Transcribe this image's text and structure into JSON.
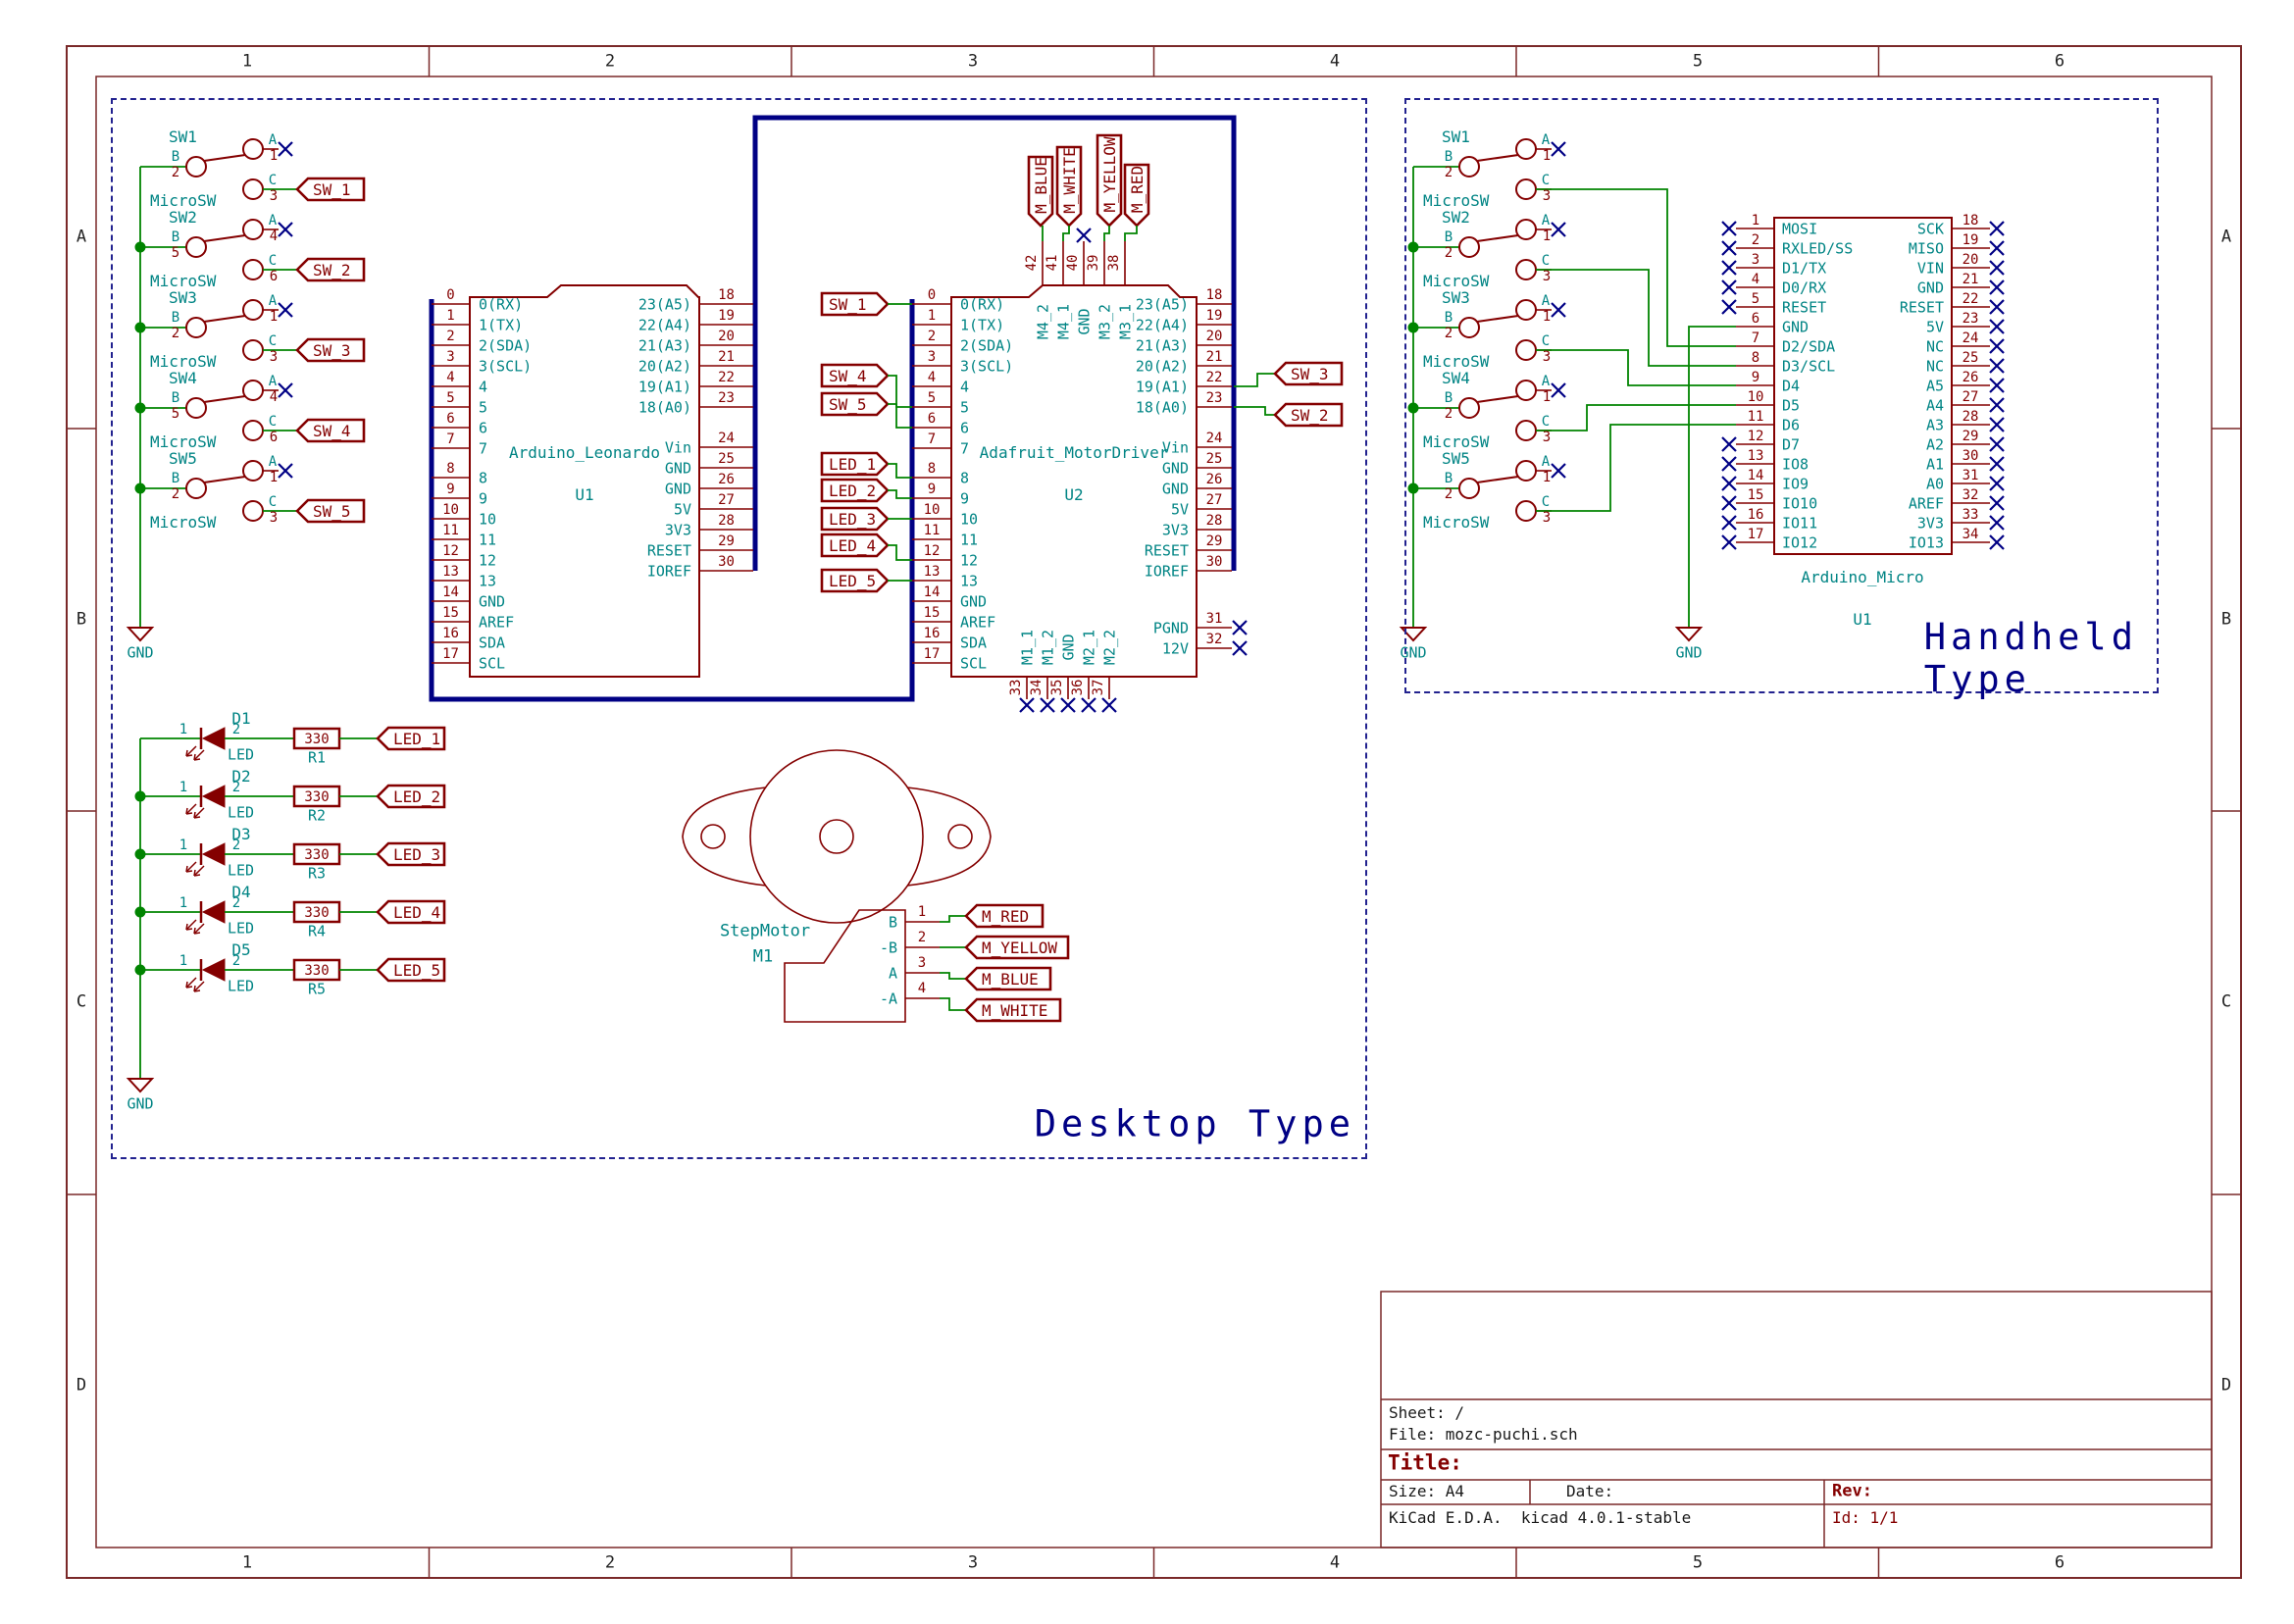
{
  "sheet": {
    "cols": [
      "1",
      "2",
      "3",
      "4",
      "5",
      "6"
    ],
    "rows": [
      "A",
      "B",
      "C",
      "D"
    ],
    "title_block": {
      "sheet": "Sheet: /",
      "file": "File: mozc-puchi.sch",
      "title": "Title:",
      "size": "Size: A4",
      "date": "Date:",
      "rev": "Rev:",
      "kicad": "KiCad E.D.A.  kicad 4.0.1-stable",
      "id": "Id: 1/1"
    }
  },
  "groups": {
    "desktop": "Desktop Type",
    "handheld": "Handheld Type"
  },
  "colors": {
    "component": "#840000",
    "field": "#008484",
    "wire": "#008400",
    "bus": "#000084",
    "noconnect": "#000084",
    "border": "#7a2929"
  },
  "misc": {
    "gnd": "GND"
  },
  "desktop": {
    "switches": [
      {
        "ref": "SW1",
        "value": "MicroSW",
        "pins": [
          {
            "l": "A",
            "n": "1"
          },
          {
            "l": "B",
            "n": "2"
          },
          {
            "l": "C",
            "n": "3"
          }
        ],
        "net": "SW_1"
      },
      {
        "ref": "SW2",
        "value": "MicroSW",
        "pins": [
          {
            "l": "A",
            "n": "4"
          },
          {
            "l": "B",
            "n": "5"
          },
          {
            "l": "C",
            "n": "6"
          }
        ],
        "net": "SW_2"
      },
      {
        "ref": "SW3",
        "value": "MicroSW",
        "pins": [
          {
            "l": "A",
            "n": "1"
          },
          {
            "l": "B",
            "n": "2"
          },
          {
            "l": "C",
            "n": "3"
          }
        ],
        "net": "SW_3"
      },
      {
        "ref": "SW4",
        "value": "MicroSW",
        "pins": [
          {
            "l": "A",
            "n": "4"
          },
          {
            "l": "B",
            "n": "5"
          },
          {
            "l": "C",
            "n": "6"
          }
        ],
        "net": "SW_4"
      },
      {
        "ref": "SW5",
        "value": "MicroSW",
        "pins": [
          {
            "l": "A",
            "n": "1"
          },
          {
            "l": "B",
            "n": "2"
          },
          {
            "l": "C",
            "n": "3"
          }
        ],
        "net": "SW_5"
      }
    ],
    "u2_left_nets": [
      "SW_1",
      "SW_4",
      "SW_5",
      "LED_1",
      "LED_2",
      "LED_3",
      "LED_4",
      "LED_5"
    ],
    "u2_right_nets": [
      "SW_3",
      "SW_2"
    ],
    "u2_top_nets": [
      "M_BLUE",
      "M_WHITE",
      "M_YELLOW",
      "M_RED"
    ],
    "leds": [
      {
        "ref": "D1",
        "value": "LED",
        "p1": "1",
        "p2": "2",
        "r_ref": "R1",
        "r_value": "330",
        "net": "LED_1"
      },
      {
        "ref": "D2",
        "value": "LED",
        "p1": "1",
        "p2": "2",
        "r_ref": "R2",
        "r_value": "330",
        "net": "LED_2"
      },
      {
        "ref": "D3",
        "value": "LED",
        "p1": "1",
        "p2": "2",
        "r_ref": "R3",
        "r_value": "330",
        "net": "LED_3"
      },
      {
        "ref": "D4",
        "value": "LED",
        "p1": "1",
        "p2": "2",
        "r_ref": "R4",
        "r_value": "330",
        "net": "LED_4"
      },
      {
        "ref": "D5",
        "value": "LED",
        "p1": "1",
        "p2": "2",
        "r_ref": "R5",
        "r_value": "330",
        "net": "LED_5"
      }
    ],
    "motor": {
      "ref": "M1",
      "value": "StepMotor",
      "pins": [
        {
          "n": "1",
          "name": "B",
          "net": "M_RED"
        },
        {
          "n": "2",
          "name": "-B",
          "net": "M_YELLOW"
        },
        {
          "n": "3",
          "name": "A",
          "net": "M_BLUE"
        },
        {
          "n": "4",
          "name": "-A",
          "net": "M_WHITE"
        }
      ]
    }
  },
  "handheld": {
    "switches": [
      {
        "ref": "SW1",
        "value": "MicroSW",
        "pins": [
          {
            "l": "A",
            "n": "1"
          },
          {
            "l": "B",
            "n": "2"
          },
          {
            "l": "C",
            "n": "3"
          }
        ]
      },
      {
        "ref": "SW2",
        "value": "MicroSW",
        "pins": [
          {
            "l": "A",
            "n": "1"
          },
          {
            "l": "B",
            "n": "2"
          },
          {
            "l": "C",
            "n": "3"
          }
        ]
      },
      {
        "ref": "SW3",
        "value": "MicroSW",
        "pins": [
          {
            "l": "A",
            "n": "1"
          },
          {
            "l": "B",
            "n": "2"
          },
          {
            "l": "C",
            "n": "3"
          }
        ]
      },
      {
        "ref": "SW4",
        "value": "MicroSW",
        "pins": [
          {
            "l": "A",
            "n": "1"
          },
          {
            "l": "B",
            "n": "2"
          },
          {
            "l": "C",
            "n": "3"
          }
        ]
      },
      {
        "ref": "SW5",
        "value": "MicroSW",
        "pins": [
          {
            "l": "A",
            "n": "1"
          },
          {
            "l": "B",
            "n": "2"
          },
          {
            "l": "C",
            "n": "3"
          }
        ]
      }
    ]
  },
  "boards": {
    "leonardo": {
      "ref": "U1",
      "value": "Arduino_Leonardo",
      "left": [
        {
          "num": "0",
          "name": "0(RX)"
        },
        {
          "num": "1",
          "name": "1(TX)"
        },
        {
          "num": "2",
          "name": "2(SDA)"
        },
        {
          "num": "3",
          "name": "3(SCL)"
        },
        {
          "num": "4",
          "name": "4"
        },
        {
          "num": "5",
          "name": "5"
        },
        {
          "num": "6",
          "name": "6"
        },
        {
          "num": "7",
          "name": "7"
        },
        {
          "num": "8",
          "name": "8"
        },
        {
          "num": "9",
          "name": "9"
        },
        {
          "num": "10",
          "name": "10"
        },
        {
          "num": "11",
          "name": "11"
        },
        {
          "num": "12",
          "name": "12"
        },
        {
          "num": "13",
          "name": "13"
        },
        {
          "num": "14",
          "name": "GND"
        },
        {
          "num": "15",
          "name": "AREF"
        },
        {
          "num": "16",
          "name": "SDA"
        },
        {
          "num": "17",
          "name": "SCL"
        }
      ],
      "right": [
        {
          "num": "18",
          "name": "23(A5)"
        },
        {
          "num": "19",
          "name": "22(A4)"
        },
        {
          "num": "20",
          "name": "21(A3)"
        },
        {
          "num": "21",
          "name": "20(A2)"
        },
        {
          "num": "22",
          "name": "19(A1)"
        },
        {
          "num": "23",
          "name": "18(A0)"
        },
        {
          "num": "24",
          "name": "Vin"
        },
        {
          "num": "25",
          "name": "GND"
        },
        {
          "num": "26",
          "name": "GND"
        },
        {
          "num": "27",
          "name": "5V"
        },
        {
          "num": "28",
          "name": "3V3"
        },
        {
          "num": "29",
          "name": "RESET"
        },
        {
          "num": "30",
          "name": "IOREF"
        }
      ]
    },
    "motordriver": {
      "ref": "U2",
      "value": "Adafruit_MotorDriver",
      "left": [
        {
          "num": "0",
          "name": "0(RX)"
        },
        {
          "num": "1",
          "name": "1(TX)"
        },
        {
          "num": "2",
          "name": "2(SDA)"
        },
        {
          "num": "3",
          "name": "3(SCL)"
        },
        {
          "num": "4",
          "name": "4"
        },
        {
          "num": "5",
          "name": "5"
        },
        {
          "num": "6",
          "name": "6"
        },
        {
          "num": "7",
          "name": "7"
        },
        {
          "num": "8",
          "name": "8"
        },
        {
          "num": "9",
          "name": "9"
        },
        {
          "num": "10",
          "name": "10"
        },
        {
          "num": "11",
          "name": "11"
        },
        {
          "num": "12",
          "name": "12"
        },
        {
          "num": "13",
          "name": "13"
        },
        {
          "num": "14",
          "name": "GND"
        },
        {
          "num": "15",
          "name": "AREF"
        },
        {
          "num": "16",
          "name": "SDA"
        },
        {
          "num": "17",
          "name": "SCL"
        }
      ],
      "right": [
        {
          "num": "18",
          "name": "23(A5)"
        },
        {
          "num": "19",
          "name": "22(A4)"
        },
        {
          "num": "20",
          "name": "21(A3)"
        },
        {
          "num": "21",
          "name": "20(A2)"
        },
        {
          "num": "22",
          "name": "19(A1)"
        },
        {
          "num": "23",
          "name": "18(A0)"
        },
        {
          "num": "24",
          "name": "Vin"
        },
        {
          "num": "25",
          "name": "GND"
        },
        {
          "num": "26",
          "name": "GND"
        },
        {
          "num": "27",
          "name": "5V"
        },
        {
          "num": "28",
          "name": "3V3"
        },
        {
          "num": "29",
          "name": "RESET"
        },
        {
          "num": "30",
          "name": "IOREF"
        }
      ],
      "top": [
        {
          "num": "42",
          "name": "M4_2",
          "nc": false
        },
        {
          "num": "41",
          "name": "M4_1",
          "nc": false
        },
        {
          "num": "40",
          "name": "GND",
          "nc": true
        },
        {
          "num": "39",
          "name": "M3_2",
          "nc": false
        },
        {
          "num": "38",
          "name": "M3_1",
          "nc": false
        }
      ],
      "bottom": [
        {
          "num": "33",
          "name": "M1_1",
          "nc": true
        },
        {
          "num": "34",
          "name": "M1_2",
          "nc": true
        },
        {
          "num": "35",
          "name": "GND",
          "nc": true
        },
        {
          "num": "36",
          "name": "M2_1",
          "nc": true
        },
        {
          "num": "37",
          "name": "M2_2",
          "nc": true
        }
      ],
      "right_bottom": [
        {
          "num": "31",
          "name": "PGND",
          "nc": true
        },
        {
          "num": "32",
          "name": "12V",
          "nc": true
        }
      ]
    },
    "micro": {
      "ref": "U1",
      "value": "Arduino_Micro",
      "left": [
        {
          "num": "1",
          "name": "MOSI",
          "nc": true
        },
        {
          "num": "2",
          "name": "RXLED/SS",
          "nc": true
        },
        {
          "num": "3",
          "name": "D1/TX",
          "nc": true
        },
        {
          "num": "4",
          "name": "D0/RX",
          "nc": true
        },
        {
          "num": "5",
          "name": "RESET",
          "nc": true
        },
        {
          "num": "6",
          "name": "GND",
          "nc": false
        },
        {
          "num": "7",
          "name": "D2/SDA",
          "nc": false
        },
        {
          "num": "8",
          "name": "D3/SCL",
          "nc": false
        },
        {
          "num": "9",
          "name": "D4",
          "nc": false
        },
        {
          "num": "10",
          "name": "D5",
          "nc": false
        },
        {
          "num": "11",
          "name": "D6",
          "nc": false
        },
        {
          "num": "12",
          "name": "D7",
          "nc": true
        },
        {
          "num": "13",
          "name": "IO8",
          "nc": true
        },
        {
          "num": "14",
          "name": "IO9",
          "nc": true
        },
        {
          "num": "15",
          "name": "IO10",
          "nc": true
        },
        {
          "num": "16",
          "name": "IO11",
          "nc": true
        },
        {
          "num": "17",
          "name": "IO12",
          "nc": true
        }
      ],
      "right": [
        {
          "num": "18",
          "name": "SCK",
          "nc": true
        },
        {
          "num": "19",
          "name": "MISO",
          "nc": true
        },
        {
          "num": "20",
          "name": "VIN",
          "nc": true
        },
        {
          "num": "21",
          "name": "GND",
          "nc": true
        },
        {
          "num": "22",
          "name": "RESET",
          "nc": true
        },
        {
          "num": "23",
          "name": "5V",
          "nc": true
        },
        {
          "num": "24",
          "name": "NC",
          "nc": true
        },
        {
          "num": "25",
          "name": "NC",
          "nc": true
        },
        {
          "num": "26",
          "name": "A5",
          "nc": true
        },
        {
          "num": "27",
          "name": "A4",
          "nc": true
        },
        {
          "num": "28",
          "name": "A3",
          "nc": true
        },
        {
          "num": "29",
          "name": "A2",
          "nc": true
        },
        {
          "num": "30",
          "name": "A1",
          "nc": true
        },
        {
          "num": "31",
          "name": "A0",
          "nc": true
        },
        {
          "num": "32",
          "name": "AREF",
          "nc": true
        },
        {
          "num": "33",
          "name": "3V3",
          "nc": true
        },
        {
          "num": "34",
          "name": "IO13",
          "nc": true
        }
      ]
    }
  }
}
